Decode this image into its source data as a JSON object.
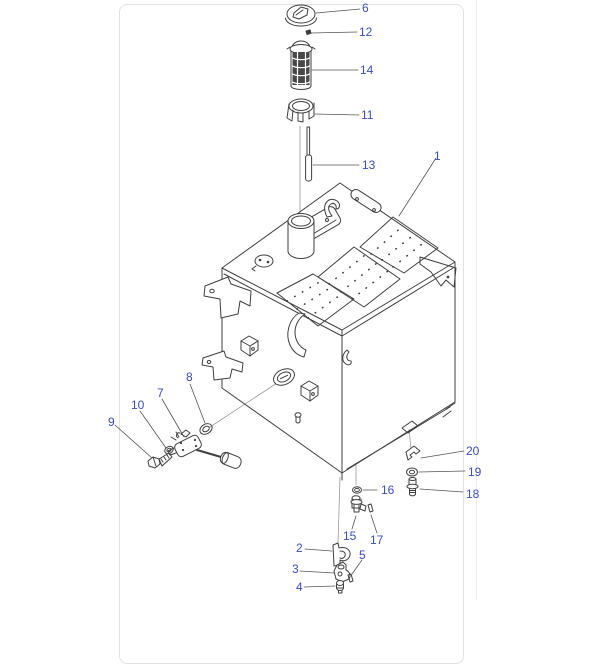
{
  "panel": {
    "background": "#ffffff",
    "border_color": "#e2e2e2",
    "divider_color": "#ededed"
  },
  "diagram": {
    "kind": "exploded-parts-diagram",
    "subject": "fuel-tank-assembly",
    "style": {
      "line_color": "#3f3f3f",
      "leader_color": "#8a8a8a",
      "label_color": "#3a4bc8"
    },
    "callouts": [
      {
        "number": "1"
      },
      {
        "number": "2"
      },
      {
        "number": "3"
      },
      {
        "number": "4"
      },
      {
        "number": "5"
      },
      {
        "number": "6"
      },
      {
        "number": "7"
      },
      {
        "number": "8"
      },
      {
        "number": "9"
      },
      {
        "number": "10"
      },
      {
        "number": "11"
      },
      {
        "number": "12"
      },
      {
        "number": "13"
      },
      {
        "number": "14"
      },
      {
        "number": "15"
      },
      {
        "number": "16"
      },
      {
        "number": "17"
      },
      {
        "number": "18"
      },
      {
        "number": "19"
      },
      {
        "number": "20"
      }
    ]
  }
}
